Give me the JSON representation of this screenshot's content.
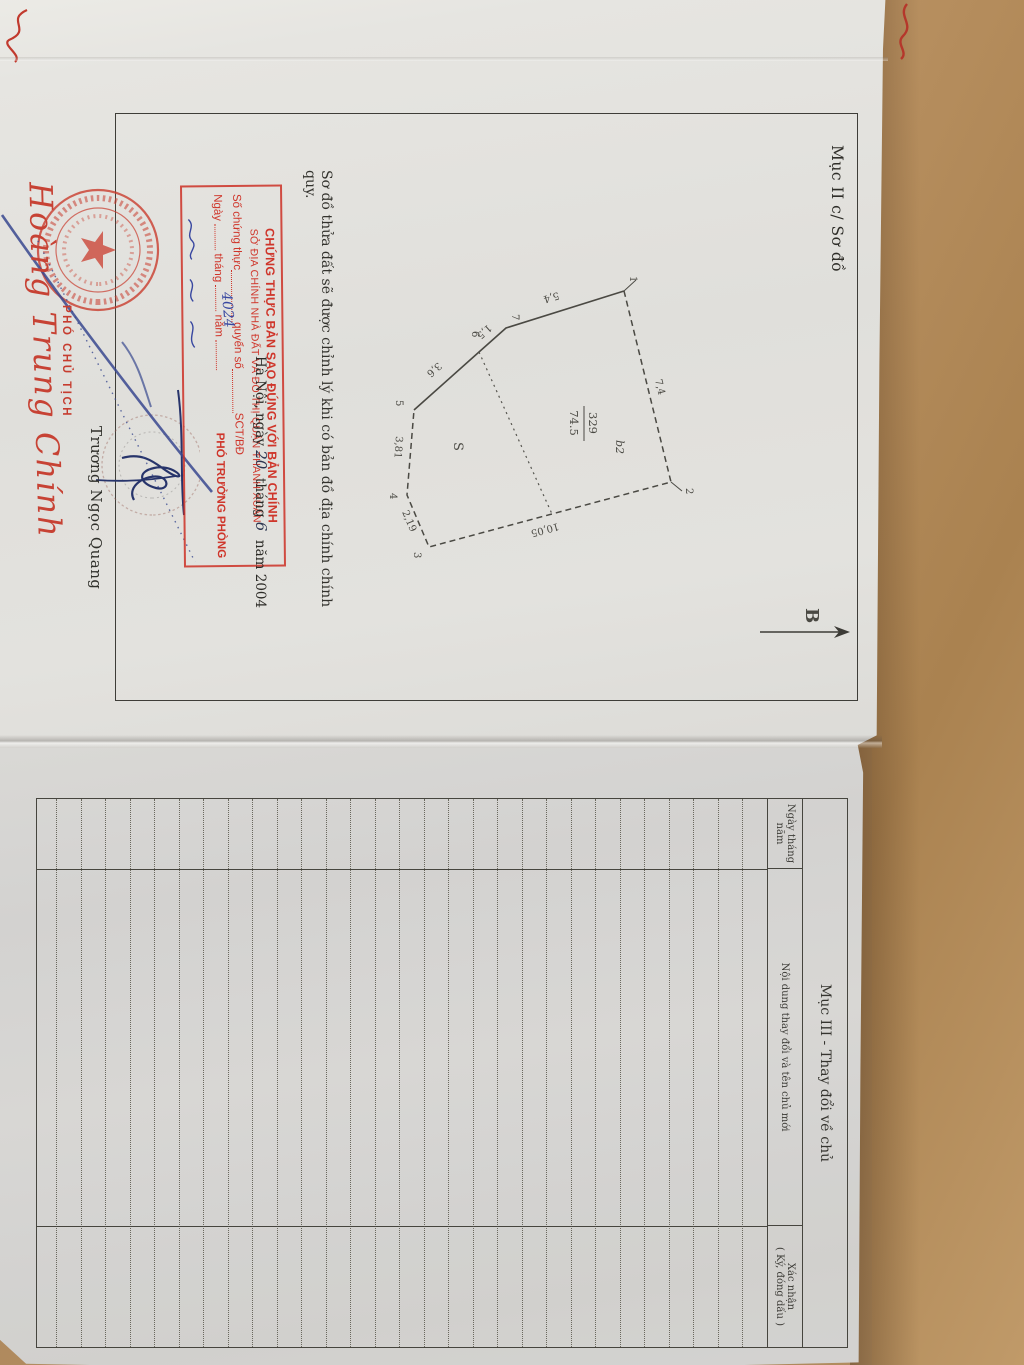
{
  "muc2": {
    "heading": "Mục II c/ Sơ đồ",
    "north_label": "B",
    "note": "Sơ đồ thửa đất sẽ được chỉnh lý khi có bản đồ địa chính chính quy.",
    "date": {
      "prefix": "Hà Nội, ngày",
      "day": "20",
      "thang": "tháng",
      "month": "6",
      "suffix": "năm 2004"
    }
  },
  "diagram": {
    "parcel_number": "329",
    "area": "74.5",
    "zone_label": "b2",
    "region_label": "S",
    "vertices": {
      "v1": "1",
      "v2": "2",
      "v3": "3",
      "v4": "4",
      "v5": "5",
      "v6": "6",
      "v7": "7"
    },
    "lengths": {
      "e71": "5,4",
      "e12": "7,4",
      "e23": "10,05",
      "e34": "2,19",
      "e45": "3,81",
      "e56": "3,6",
      "e67": "1,5"
    }
  },
  "stamp": {
    "line1": "CHỨNG THỰC BẢN SAO ĐÚNG VỚI BẢN CHÍNH",
    "line2": "SỞ ĐỊA CHÍNH NHÀ ĐẤT VÀ ĐÔ THỊ QUẬN THANH XUÂN",
    "line3_a": "Số chứng thực",
    "line3_b": "quyển số",
    "line3_c": "SCT/BĐ",
    "hand_number": "4024",
    "line4_a": "Ngày",
    "line4_b": "tháng",
    "line4_c": "năm",
    "title_right": "PHÓ TRƯỞNG PHÒNG"
  },
  "officials": {
    "left_title": "PHÓ CHỦ TỊCH",
    "left_name": "Hoàng Trung Chính",
    "right_name": "Trương Ngọc Quang"
  },
  "muc3": {
    "title": "Mục III - Thay đổi về chủ",
    "col1_line1": "Ngày tháng",
    "col1_line2": "năm",
    "col2": "Nội dung thay đổi và tên chủ mới",
    "col3_line1": "Xác nhận",
    "col3_line2": "( Ký, đóng dấu )"
  }
}
